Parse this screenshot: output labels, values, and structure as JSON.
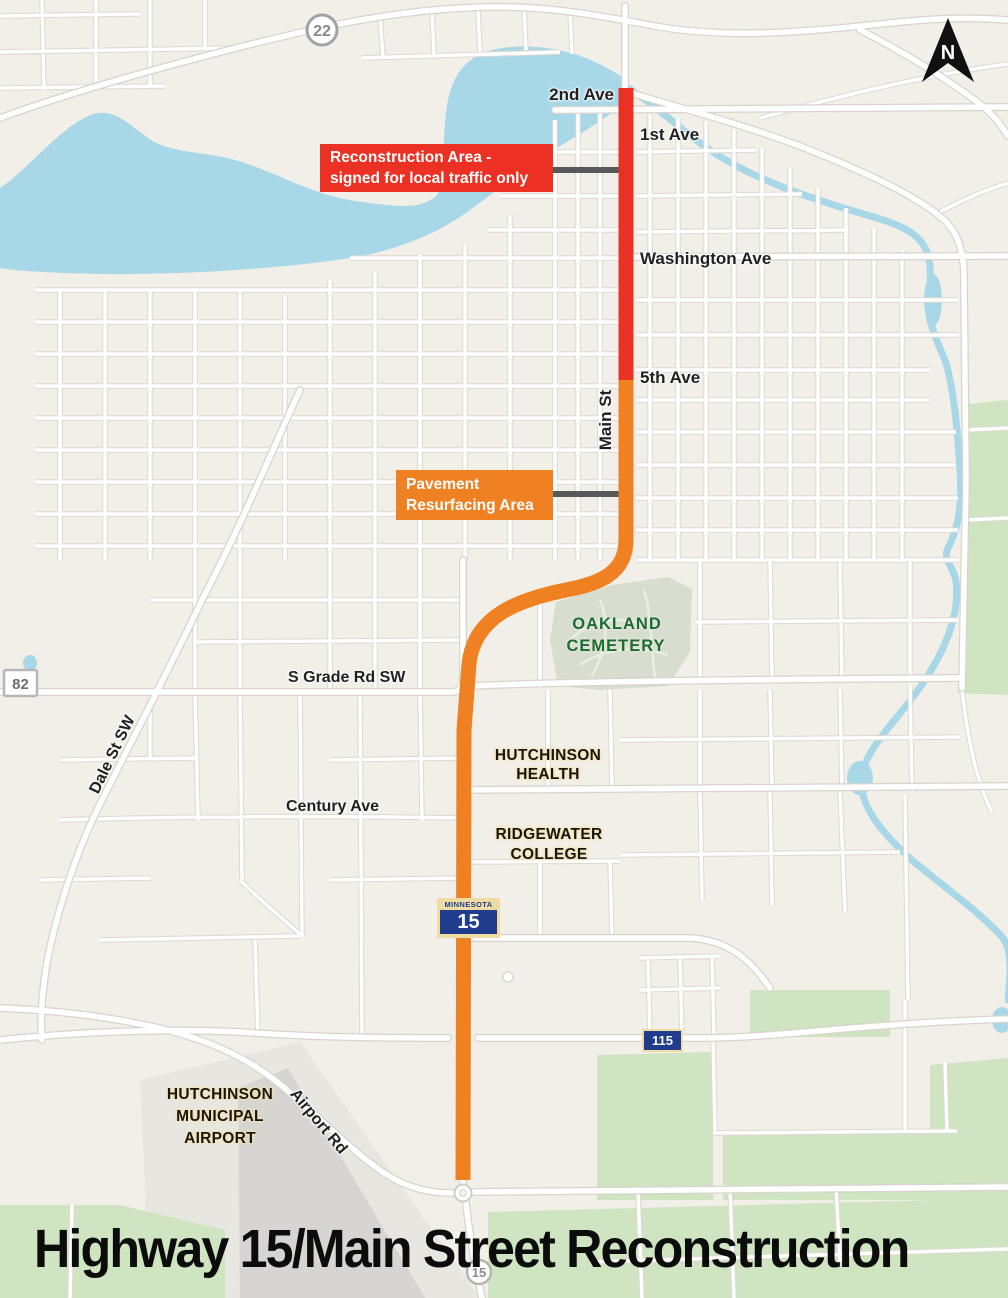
{
  "title": "Highway 15/Main Street Reconstruction",
  "north_arrow": {
    "label": "N"
  },
  "callouts": {
    "reconstruction": {
      "line1": "Reconstruction Area -",
      "line2": "signed for local traffic only"
    },
    "resurfacing": {
      "line1": "Pavement",
      "line2": "Resurfacing Area"
    }
  },
  "streets": {
    "second_ave": "2nd Ave",
    "first_ave": "1st Ave",
    "washington_ave": "Washington Ave",
    "fifth_ave": "5th Ave",
    "main_st": "Main St",
    "s_grade_rd": "S Grade Rd SW",
    "century_ave": "Century Ave",
    "dale_st": "Dale St SW",
    "airport_rd": "Airport Rd"
  },
  "places": {
    "cemetery": {
      "line1": "OAKLAND",
      "line2": "CEMETERY"
    },
    "health": {
      "line1": "HUTCHINSON",
      "line2": "HEALTH"
    },
    "college": {
      "line1": "RIDGEWATER",
      "line2": "COLLEGE"
    },
    "airport": {
      "line1": "HUTCHINSON",
      "line2": "MUNICIPAL",
      "line3": "AIRPORT"
    }
  },
  "shields": {
    "hwy22": "22",
    "hwy82": "82",
    "mn15": {
      "state": "MINNESOTA",
      "number": "15"
    },
    "hwy115": "115",
    "mn15_small": "15"
  },
  "colors": {
    "reconstruction_red": "#ea3123",
    "resurfacing_orange": "#f08122",
    "water_blue": "#a8d7e7",
    "green_area": "#cfe4c0",
    "connector_gray": "#58595b"
  }
}
